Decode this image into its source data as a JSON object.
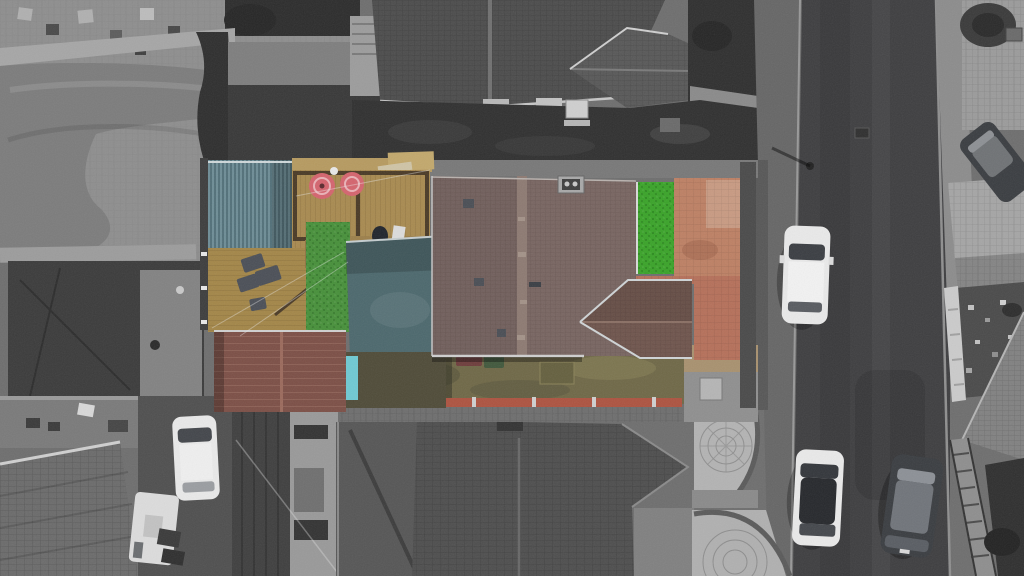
{
  "scene": {
    "type": "aerial-drone-photograph",
    "subject": "top-down view of a terraced house and rear garden shown in colour, surrounding streets and houses desaturated to greyscale",
    "features": [
      "teal-corrugated-shed-roof",
      "teal-extension-roof",
      "timber-decking-with-pink-round-chairs",
      "grey-garden-sofa-set",
      "wooden-bench",
      "artificial-grass",
      "brown-tiled-main-roof-with-chimney",
      "brown-gable-projection",
      "green-turf-strip",
      "salmon-block-paved-patio",
      "red-garage-roof",
      "terracotta-coping-front-wall",
      "olive-front-lawn-with-bins",
      "asphalt-road",
      "parked-white-cars",
      "parked-dark-cars",
      "white-caravan",
      "grey-neighbour-roofs",
      "circular-paved-patios",
      "stepped-wall-with-railing"
    ]
  },
  "palette": {
    "base": "#6e6e6e",
    "road": "#3e3e40",
    "pavement": "#666666",
    "pavement_right": "#8c8c8c",
    "lawn_gray": "#7c7c7c",
    "paving_gray": "#8e8e8e",
    "patio_brick_gray": "#898989",
    "dark_roof": "#303030",
    "dark_roof2": "#383838",
    "hedge_dark": "#2e2e2e",
    "yard_dark": "#3b3b3b",
    "concrete_pad": "#828282",
    "neighbor_roof": "#4c4c4c",
    "neighbor_wing": "#585858",
    "bottom_roof": "#4e4e4e",
    "bottom_left_roof": "#6b6b6b",
    "right_roof": "#818181",
    "shed_teal": "#5d808a",
    "extension_teal": "#4c686d",
    "cyan_tarp": "#6fc9d2",
    "deck_wood": "#a88a50",
    "deck_wood2": "#a38648",
    "deck_frame": "#4a3a26",
    "bench_wood": "#8f7343",
    "fence_wood": "#b69a60",
    "grass_green": "#47903a",
    "grass_bright": "#3aa329",
    "main_roof_brown": "#786561",
    "ridge_brown": "#8d7a72",
    "gable_brown": "#6f554d",
    "patio_salmon": "#bd8064",
    "paving_pink": "#b5705a",
    "olive_lawn": "#6f6847",
    "coping_terracotta": "#ad5340",
    "garage_red": "#7c4f46",
    "bin_red": "#6e3d3c",
    "bin_green": "#41583c",
    "sofa_gray": "#4b4f57",
    "chair_pink": "#d4646e",
    "car_white": "#e9e9e9",
    "car_dark": "#3a3d41",
    "car_glass": "#43464b",
    "caravan_white": "#dcdcdc",
    "wall_white": "#cbcbcb",
    "stone_garden": "#4a4a4a",
    "dark_garden": "#2f2f2f",
    "circle_patio": "#b3b3b3",
    "tan_path": "#a8916f",
    "neighbor_wall_light": "#999999",
    "neighbor_dark_side": "#3f3f3f"
  }
}
